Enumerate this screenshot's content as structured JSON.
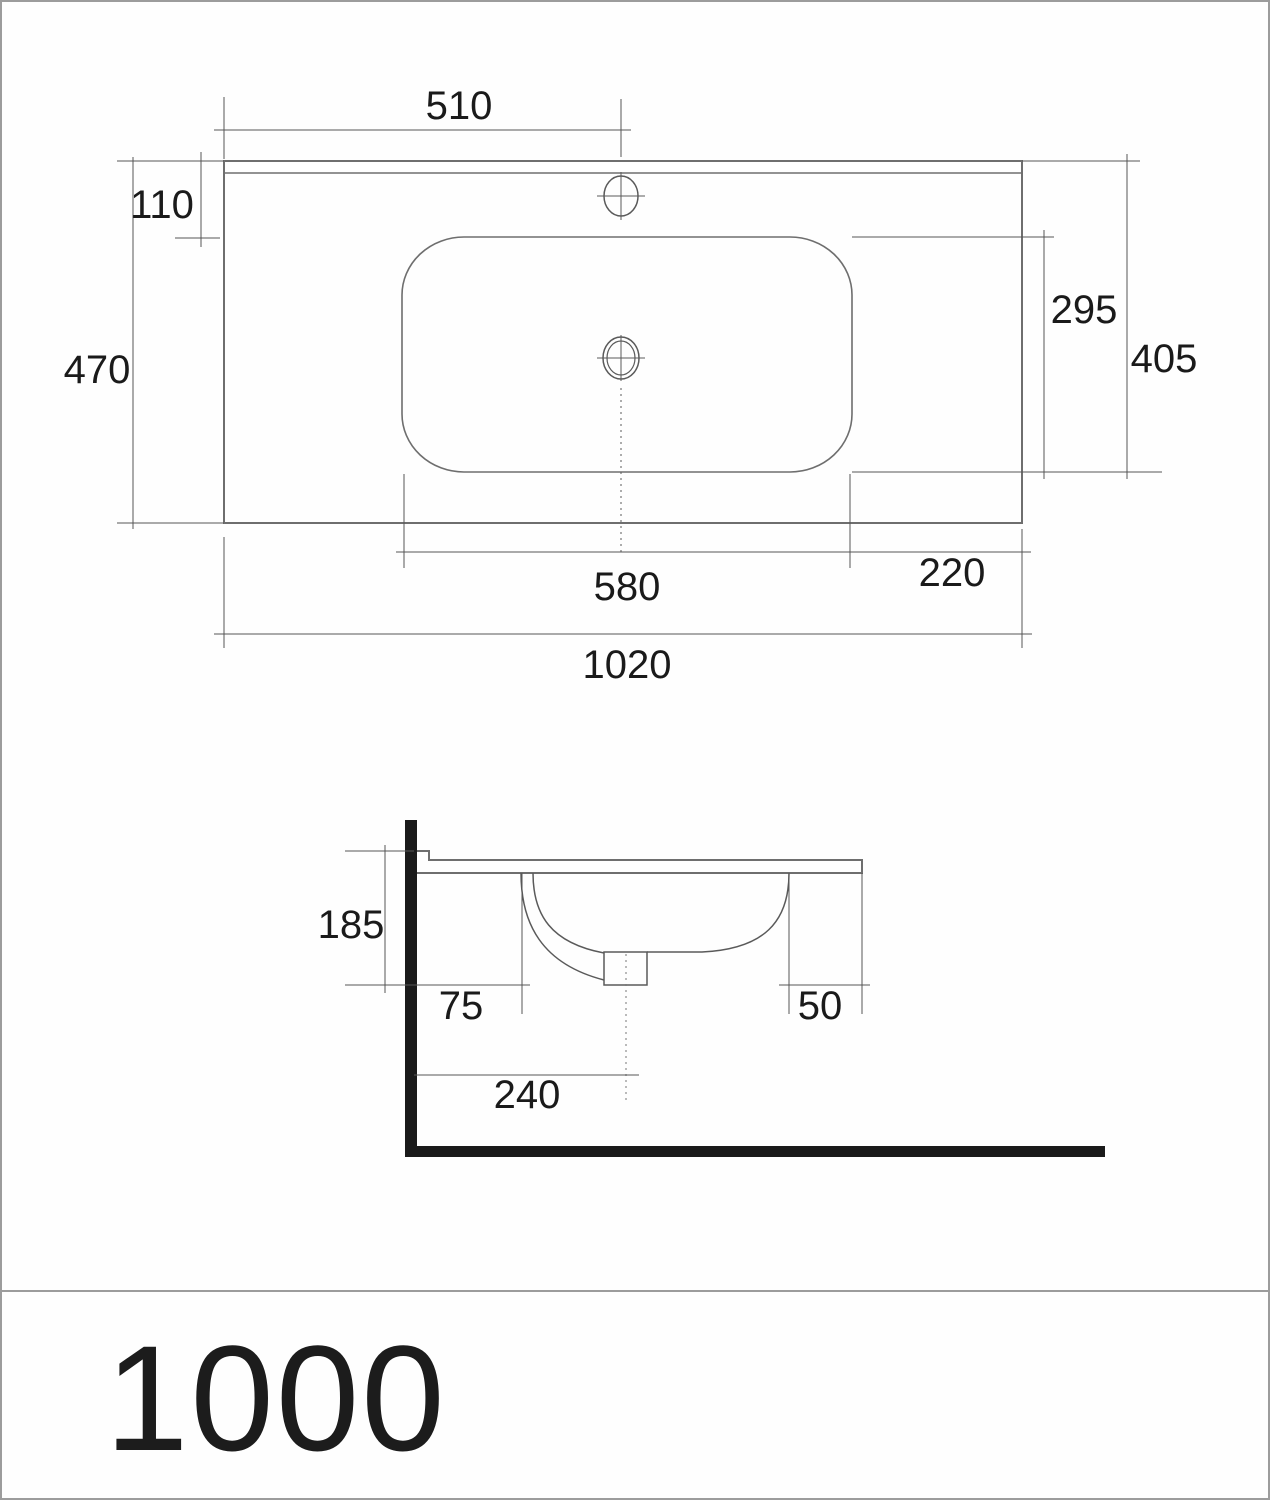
{
  "page": {
    "background": "#fefefe",
    "border_color": "#9c9c9c",
    "thin_line_color": "#555555",
    "outline_color": "#6e6e6e",
    "solid_color": "#1a1a1a",
    "text_color": "#1a1a1a"
  },
  "drawing": {
    "title": "1000",
    "plan_view": {
      "name": "washbasin top view",
      "dimensions": {
        "faucet_offset_from_left": "510",
        "rim_to_basin": "110",
        "overall_depth": "470",
        "basin_inner_depth": "295",
        "rim_to_basin_front": "405",
        "basin_inner_width": "580",
        "basin_to_right_edge": "220",
        "overall_width": "1020"
      }
    },
    "side_view": {
      "name": "washbasin side section",
      "dimensions": {
        "bowl_height": "185",
        "wall_to_bowl": "75",
        "bowl_to_front_edge": "50",
        "wall_to_drain_center": "240"
      }
    }
  }
}
